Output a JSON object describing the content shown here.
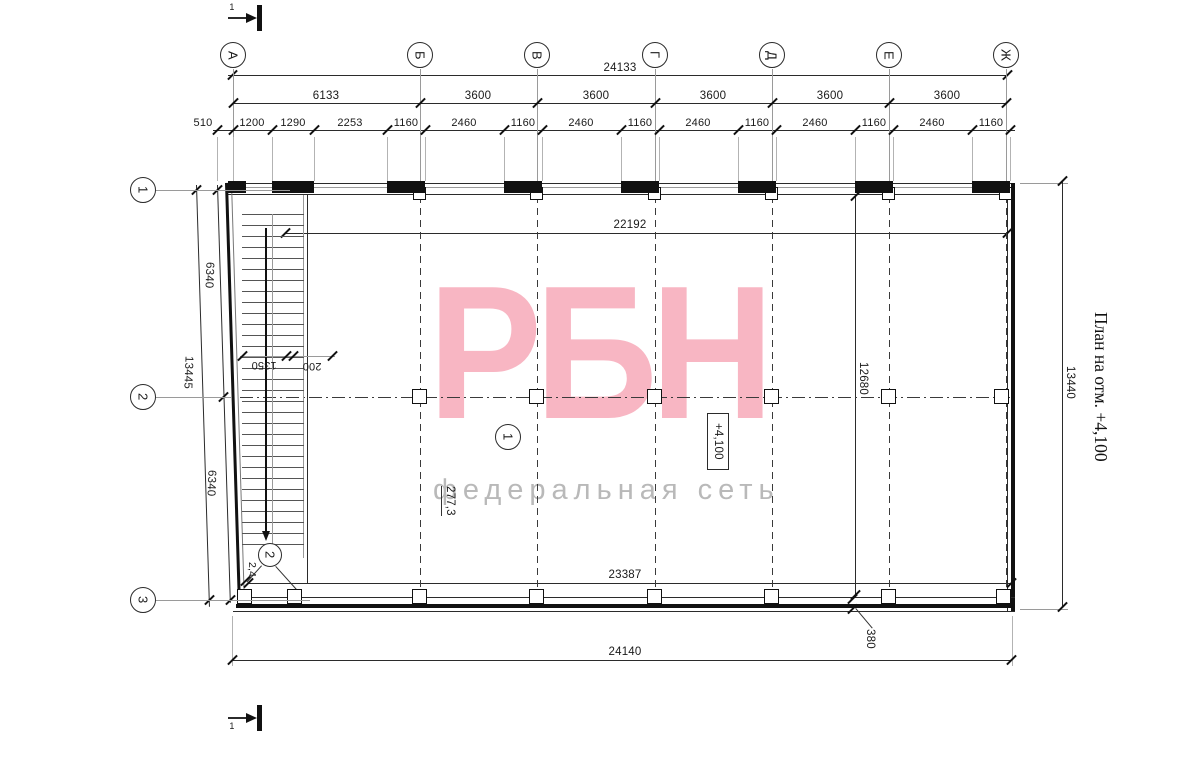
{
  "drawing": {
    "title": "План на отм. +4,100",
    "section_mark_label": "1"
  },
  "axes": {
    "top": [
      "А",
      "Б",
      "В",
      "Г",
      "Д",
      "Е",
      "Ж"
    ],
    "side": [
      "1",
      "2",
      "3"
    ]
  },
  "dims": {
    "top_total": "24133",
    "top_axes": [
      "6133",
      "3600",
      "3600",
      "3600",
      "3600",
      "3600"
    ],
    "top_detail": [
      "510",
      "1200",
      "1290",
      "2253",
      "1160",
      "2460",
      "1160",
      "2460",
      "1160",
      "2460",
      "1160",
      "2460",
      "1160",
      "2460",
      "1160"
    ],
    "left": [
      "6340",
      "13445",
      "6340"
    ],
    "interior_top": "22192",
    "interior_bottom": "23387",
    "interior_height": "12680",
    "bottom_total": "24140",
    "right_total": "13440",
    "wall_thickness": "380",
    "stair_flight": "1350",
    "stair_gap": "200"
  },
  "annotations": {
    "level_mark": "+4,100",
    "area": "277,3",
    "node1": "1",
    "node2": "2",
    "stair_note": "2,4"
  },
  "watermark": {
    "logo": "РБН",
    "tagline": "федеральная сеть",
    "logo_color": "#f8b6c3",
    "tagline_color": "#b9b9b9"
  }
}
